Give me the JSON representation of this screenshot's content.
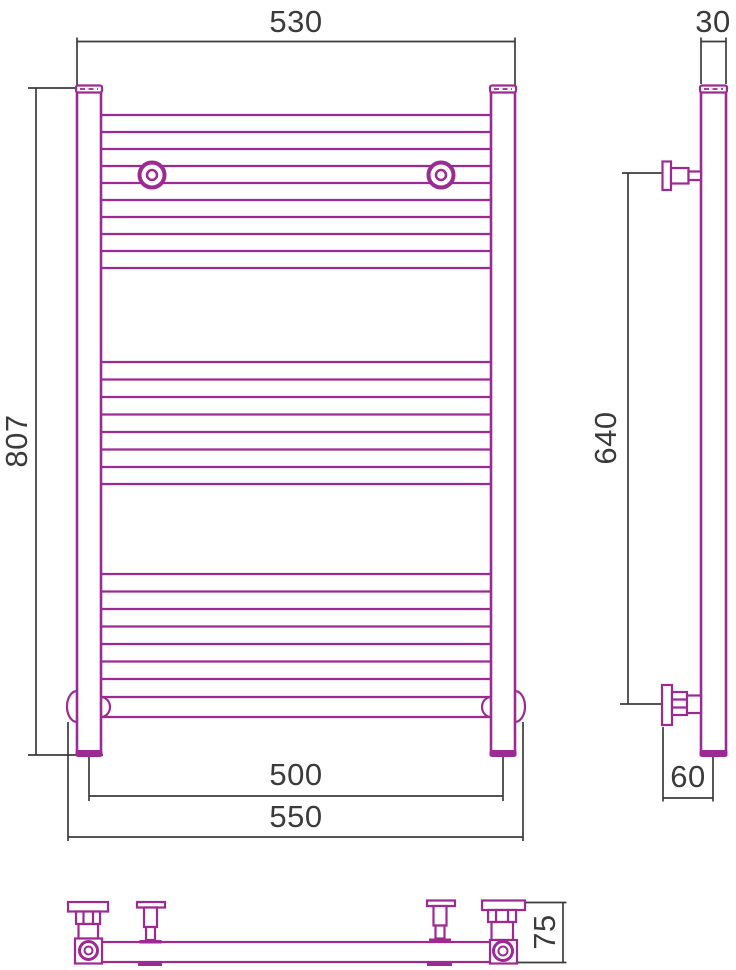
{
  "colors": {
    "drawing": "#9c2a92",
    "dimension": "#3b3b3b",
    "background": "#ffffff"
  },
  "dimensions": {
    "overall_width": "530",
    "post_diameter": "30",
    "overall_height": "807",
    "bracket_span": "640",
    "connection_spacing": "500",
    "bottom_rail_width": "550",
    "wall_to_axis": "60",
    "depth": "75"
  }
}
